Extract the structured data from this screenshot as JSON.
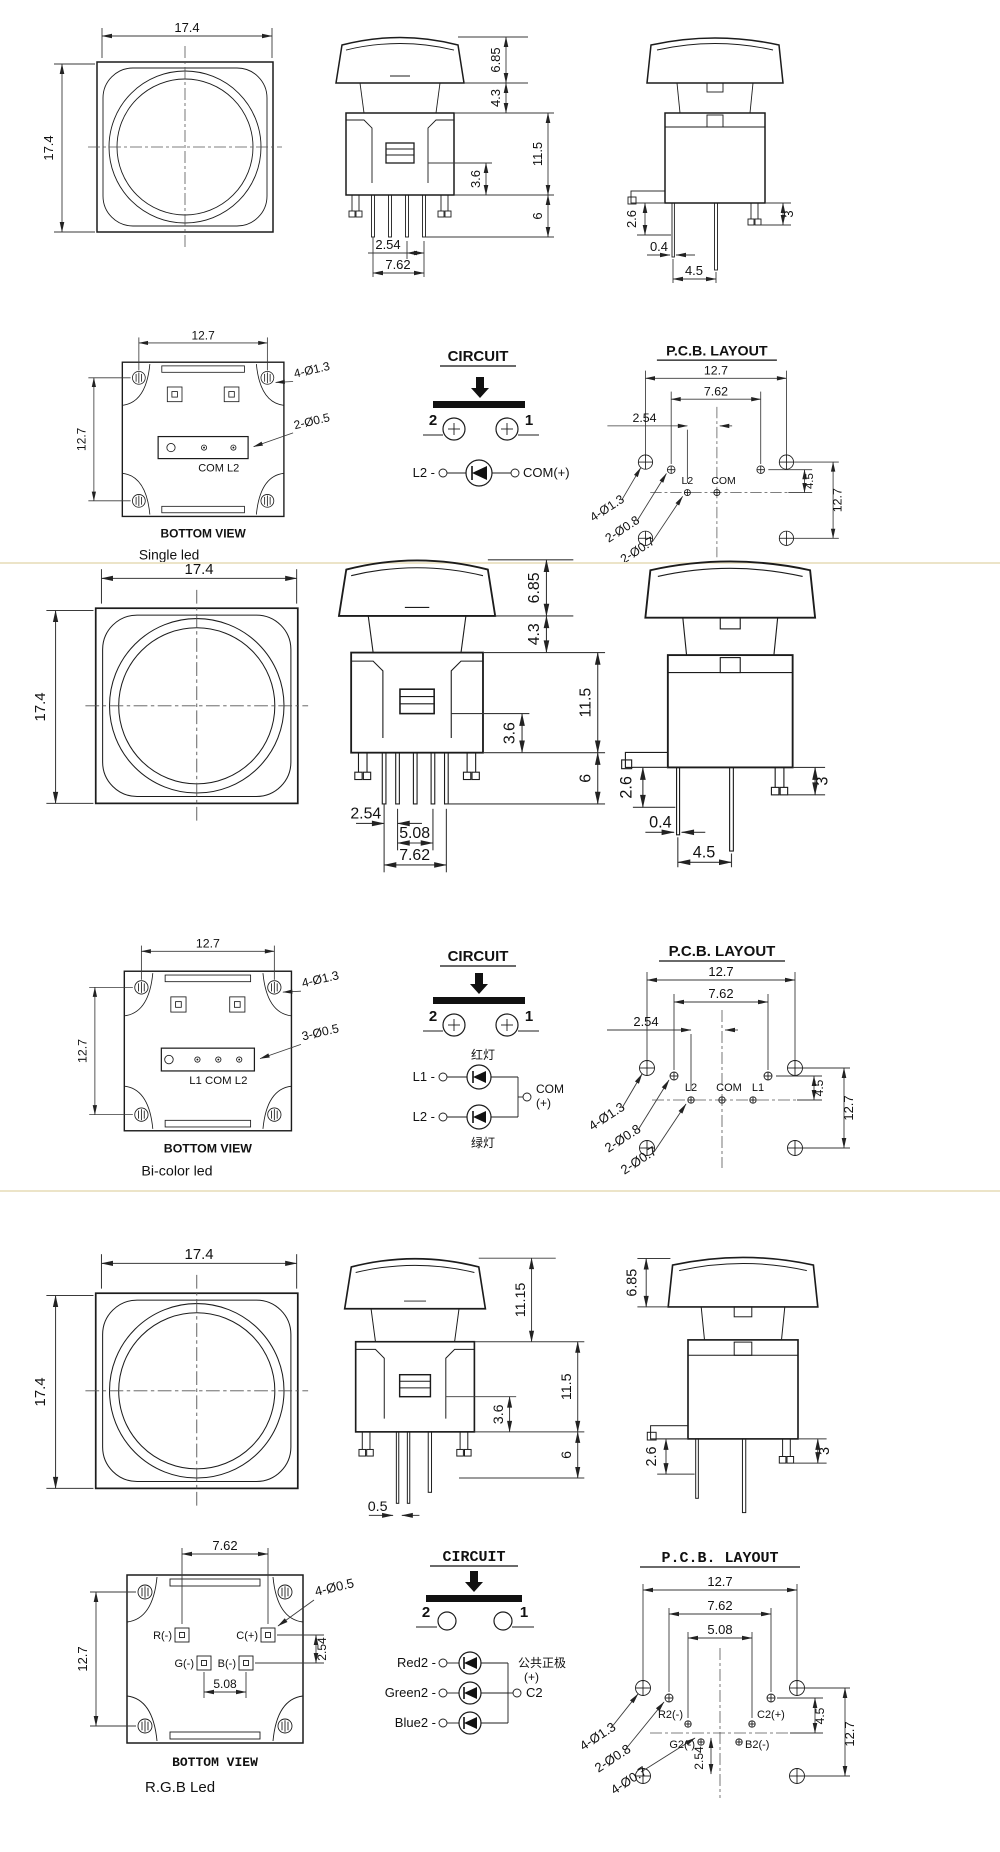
{
  "page": {
    "background": "#ffffff",
    "line_color": "#1c1c1c",
    "divider_color": "#ece4c8"
  },
  "sections": {
    "s1": {
      "name": "Single led",
      "front": {
        "width": "17.4",
        "height": "17.4"
      },
      "elevation": {
        "cap_height": "6.85",
        "neck_height": "4.3",
        "inner_height": "3.6",
        "body_height": "11.5",
        "pin_length": "6",
        "pin_pitch": "2.54",
        "pin_span": "7.62"
      },
      "side": {
        "offset": "2.6",
        "pin_width": "0.4",
        "pin_gap": "4.5",
        "snap_length": "3"
      },
      "bottom": {
        "width": "12.7",
        "height": "12.7",
        "corner_holes": "4-Ø1.3",
        "pin_holes": "2-Ø0.5",
        "pin_labels": "COM  L2",
        "caption": "BOTTOM VIEW"
      },
      "circuit": {
        "title": "CIRCUIT",
        "terminal_2": "2",
        "terminal_1": "1",
        "led_left": "L2 -",
        "led_right": "COM(+)"
      },
      "pcb": {
        "title": "P.C.B. LAYOUT",
        "width": "12.7",
        "span": "7.62",
        "pitch": "2.54",
        "corner_holes": "4-Ø1.3",
        "switch_holes": "2-Ø0.8",
        "led_holes": "2-Ø0.7",
        "pad_l2": "L2",
        "pad_com": "COM",
        "dim_45": "4.5",
        "height": "12.7"
      }
    },
    "s2": {
      "name": "Bi-color led",
      "front": {
        "width": "17.4",
        "height": "17.4"
      },
      "elevation": {
        "cap_height": "6.85",
        "neck_height": "4.3",
        "inner_height": "3.6",
        "body_height": "11.5",
        "pin_length": "6",
        "pin_pitch": "2.54",
        "mid_span": "5.08",
        "pin_span": "7.62"
      },
      "side": {
        "offset": "2.6",
        "pin_width": "0.4",
        "pin_gap": "4.5",
        "snap_length": "3"
      },
      "bottom": {
        "width": "12.7",
        "height": "12.7",
        "corner_holes": "4-Ø1.3",
        "pin_holes": "3-Ø0.5",
        "pin_labels": "L1  COM  L2",
        "caption": "BOTTOM VIEW"
      },
      "circuit": {
        "title": "CIRCUIT",
        "terminal_2": "2",
        "terminal_1": "1",
        "red_label": "红灯",
        "green_label": "绿灯",
        "led1_left": "L1 -",
        "led2_left": "L2 -",
        "com": "COM",
        "plus": "(+)"
      },
      "pcb": {
        "title": "P.C.B. LAYOUT",
        "width": "12.7",
        "span": "7.62",
        "pitch": "2.54",
        "corner_holes": "4-Ø1.3",
        "switch_holes": "2-Ø0.8",
        "led_holes": "2-Ø0.7",
        "pad_l2": "L2",
        "pad_com": "COM",
        "pad_l1": "L1",
        "dim_45": "4.5",
        "height": "12.7"
      }
    },
    "s3": {
      "name": "R.G.B Led",
      "front": {
        "width": "17.4",
        "height": "17.4"
      },
      "elevation": {
        "total_height": "11.15",
        "body_height": "11.5",
        "inner_height": "3.6",
        "pin_length": "6",
        "pin_width": "0.5"
      },
      "side": {
        "cap_height": "6.85",
        "offset": "2.6",
        "snap_length": "3"
      },
      "bottom": {
        "top_span": "7.62",
        "height": "12.7",
        "pad_r": "R(-)",
        "pad_c": "C(+)",
        "pad_g": "G(-)",
        "pad_b": "B(-)",
        "span_508": "5.08",
        "pitch_254": "2.54",
        "pin_holes": "4-Ø0.5",
        "caption": "BOTTOM VIEW"
      },
      "circuit": {
        "title": "CIRCUIT",
        "terminal_2": "2",
        "terminal_1": "1",
        "red": "Red2 -",
        "green": "Green2 -",
        "blue": "Blue2 -",
        "common": "公共正极",
        "plus": "(+)",
        "c2": "C2"
      },
      "pcb": {
        "title": "P.C.B. LAYOUT",
        "width": "12.7",
        "span": "7.62",
        "inner_span": "5.08",
        "corner_holes": "4-Ø1.3",
        "switch_holes": "2-Ø0.8",
        "led_holes": "4-Ø0.7",
        "pad_r2": "R2(-)",
        "pad_c2": "C2(+)",
        "pad_g2": "G2(-)",
        "pad_b2": "B2(-)",
        "pitch": "2.54",
        "dim_45": "4.5",
        "height": "12.7"
      }
    }
  }
}
